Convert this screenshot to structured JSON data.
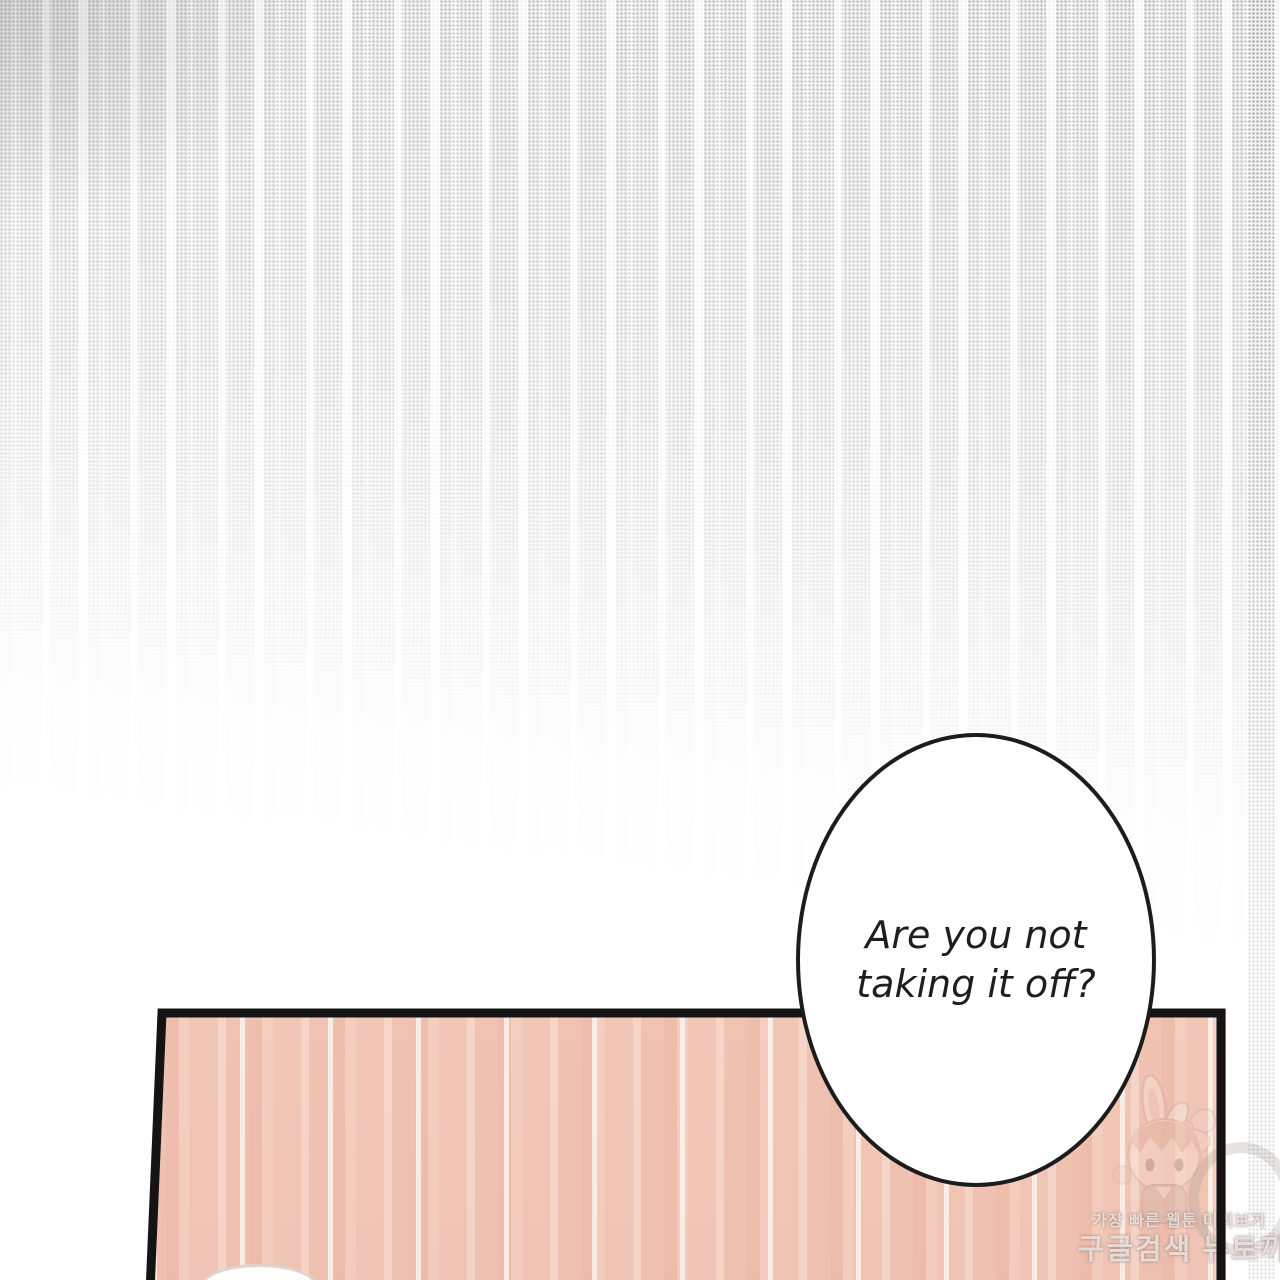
{
  "page": {
    "kind": "webtoon-comic-panel"
  },
  "speech_bubble": {
    "lines": [
      "Are you not",
      "taking it off?"
    ]
  },
  "watermark": {
    "tagline": "가장 빠른 웹툰 미리보기",
    "title": "구글검색 뉴토끼",
    "mascot": "bunny-girl"
  },
  "colors": {
    "background": "#ffffff",
    "halftone_dot": "#c9c9c9",
    "wood_base": "#f5c9b8",
    "wood_light": "#fce4d7",
    "wood_dark": "#eeb5a3",
    "panel_border": "#141414",
    "bubble_fill": "#ffffff",
    "bubble_border": "#1c1c1c",
    "text_color": "#1e1e1e",
    "watermark_text": "rgba(255,255,255,0.70)"
  }
}
